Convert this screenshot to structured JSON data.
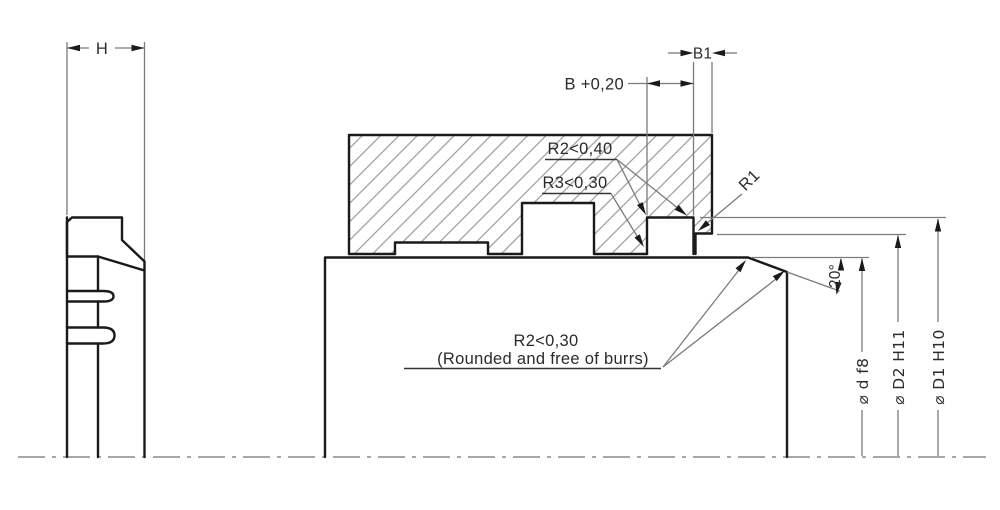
{
  "drawing": {
    "labels": {
      "h": "H",
      "b": "B +0,20",
      "b1": "B1",
      "r2_groove": "R2<0,40",
      "r3_groove": "R3<0,30",
      "r1": "R1",
      "angle": "20°",
      "note_line1": "R2<0,30",
      "note_line2": "(Rounded and free of burrs)",
      "dia_rod": "⌀ d f8",
      "dia_step": "⌀ D2 H11",
      "dia_groove": "⌀ D1 H10"
    },
    "colors": {
      "line": "#1a1a1a",
      "thin_line": "#7b7b7b",
      "seal_fill": "#cacaca",
      "hatch": "#9a9a9a",
      "background": "#ffffff"
    }
  }
}
